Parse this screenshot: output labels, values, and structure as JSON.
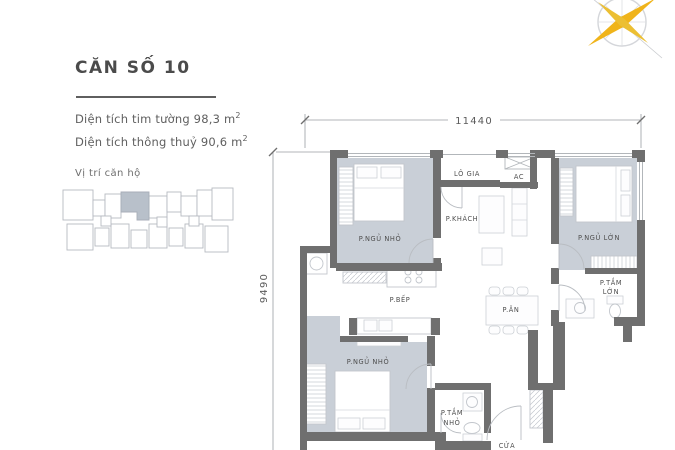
{
  "info_panel": {
    "title": "CĂN SỐ 10",
    "area_lines": [
      {
        "text": "Diện tích tim tường 98,3 m",
        "sup": "2"
      },
      {
        "text": "Diện tích thông thuỷ 90,6 m",
        "sup": "2"
      }
    ],
    "location_label": "Vị trí căn hộ"
  },
  "floor_plan": {
    "dimensions": {
      "width_label": "11440",
      "height_label": "9490"
    },
    "rooms": [
      {
        "id": "bedroom-small-top",
        "lines": [
          "P.NGỦ NHỎ"
        ]
      },
      {
        "id": "loggia",
        "lines": [
          "LÔ GIA"
        ]
      },
      {
        "id": "ac",
        "lines": [
          "AC"
        ]
      },
      {
        "id": "living",
        "lines": [
          "P.KHÁCH"
        ]
      },
      {
        "id": "bedroom-large",
        "lines": [
          "P.NGỦ LỚN"
        ]
      },
      {
        "id": "bath-large",
        "lines": [
          "P.TẮM",
          "LỚN"
        ]
      },
      {
        "id": "kitchen",
        "lines": [
          "P.BẾP"
        ]
      },
      {
        "id": "dining",
        "lines": [
          "P.ĂN"
        ]
      },
      {
        "id": "bedroom-small-bottom",
        "lines": [
          "P.NGỦ NHỎ"
        ]
      },
      {
        "id": "bath-small",
        "lines": [
          "P.TẮM",
          "NHỎ"
        ]
      },
      {
        "id": "entry",
        "lines": [
          "CỬA"
        ]
      }
    ]
  },
  "colors": {
    "wall": "#6f6f6f",
    "bedroom_floor": "#c9cfd7",
    "compass_star": "#f0b41a",
    "locator_highlight": "#b8c0ca",
    "text": "#4e4e4e"
  }
}
